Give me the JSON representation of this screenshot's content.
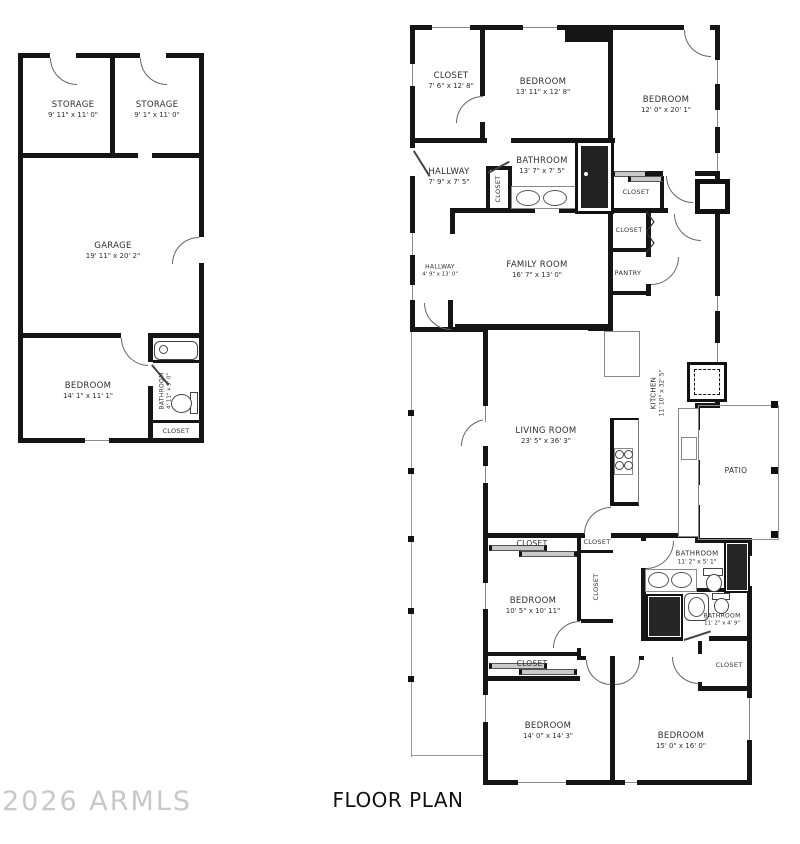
{
  "title": "FLOOR PLAN",
  "watermark": "2026 ARMLS",
  "colors": {
    "wall": "#151515",
    "label": "#2f2f2f",
    "watermark": "#c8c8c8"
  },
  "left_building": {
    "storage_left": {
      "name": "STORAGE",
      "dims": "9' 11\" x 11' 0\""
    },
    "storage_right": {
      "name": "STORAGE",
      "dims": "9' 1\" x 11' 0\""
    },
    "garage": {
      "name": "GARAGE",
      "dims": "19' 11\" x 20' 2\""
    },
    "bedroom": {
      "name": "BEDROOM",
      "dims": "14' 1\" x 11' 1\""
    },
    "bathroom": {
      "name": "BATHROOM",
      "dims": "4' 11\" x 9' 0\""
    },
    "closet": {
      "name": "CLOSET"
    }
  },
  "main_house": {
    "closet_front": {
      "name": "CLOSET",
      "dims": "7' 6\" x 12' 8\""
    },
    "bedroom_front": {
      "name": "BEDROOM",
      "dims": "13' 11\" x 12' 8\""
    },
    "bedroom_ne": {
      "name": "BEDROOM",
      "dims": "12' 0\" x 20' 1\""
    },
    "hallway_front": {
      "name": "HALLWAY",
      "dims": "7' 9\" x 7' 5\""
    },
    "bathroom_front": {
      "name": "BATHROOM",
      "dims": "13' 7\" x 7' 5\""
    },
    "hall_closet": {
      "name": "CLOSET"
    },
    "closet_ne": {
      "name": "CLOSET"
    },
    "closet_mid": {
      "name": "CLOSET"
    },
    "pantry": {
      "name": "PANTRY"
    },
    "hallway_mid": {
      "name": "HALLWAY",
      "dims": "4' 9\" x 13' 0\""
    },
    "family_room": {
      "name": "FAMILY ROOM",
      "dims": "16' 7\" x 13' 0\""
    },
    "kitchen": {
      "name": "KITCHEN",
      "dims": "11' 10\" x 32' 5\""
    },
    "living_room": {
      "name": "LIVING ROOM",
      "dims": "23' 5\" x 36' 3\""
    },
    "patio": {
      "name": "PATIO"
    },
    "closet_s1": {
      "name": "CLOSET"
    },
    "closet_s2": {
      "name": "CLOSET"
    },
    "closet_s3": {
      "name": "CLOSET"
    },
    "bedroom_mid": {
      "name": "BEDROOM",
      "dims": "10' 5\" x 10' 11\""
    },
    "bathroom_master": {
      "name": "BATHROOM",
      "dims": "11' 2\" x 5' 1\""
    },
    "bathroom_hall": {
      "name": "BATHROOM",
      "dims": "11' 2\" x 4' 9\""
    },
    "closet_se": {
      "name": "CLOSET"
    },
    "closet_sw": {
      "name": "CLOSET"
    },
    "bedroom_sw": {
      "name": "BEDROOM",
      "dims": "14' 0\" x 14' 3\""
    },
    "bedroom_se": {
      "name": "BEDROOM",
      "dims": "15' 0\" x 16' 0\""
    }
  }
}
